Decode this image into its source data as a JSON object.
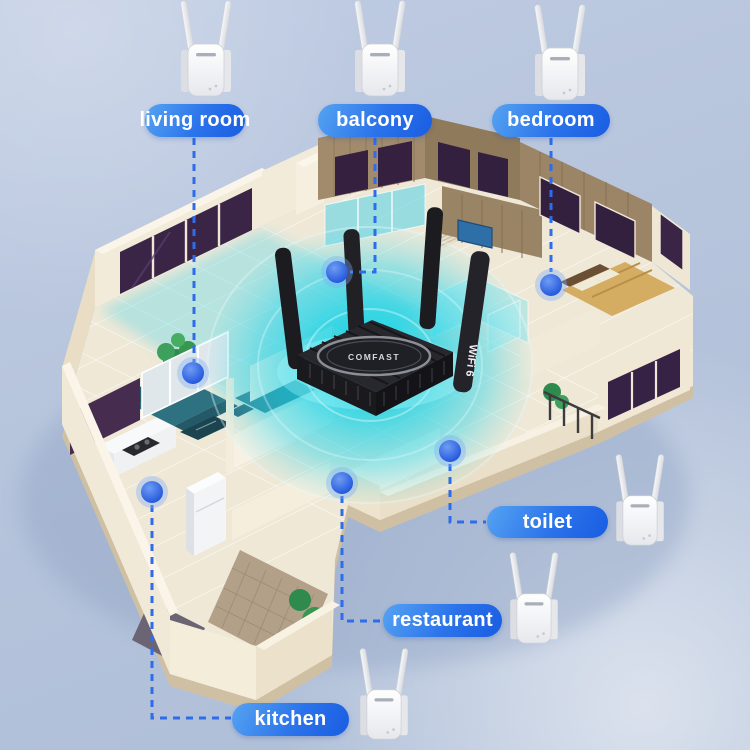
{
  "scene": {
    "description": "isometric house floor plan with wifi mesh coverage",
    "background_color": "#b6c4dc",
    "coverage_color": "#0fd3e8",
    "accent_blue": "#2d6cea",
    "label_gradient_start": "#55a3f2",
    "label_gradient_end": "#195de2"
  },
  "router": {
    "brand": "COMFAST",
    "badge": "WiFi 6",
    "antenna_count": 4
  },
  "extenders": {
    "count": 6,
    "color": "white",
    "antenna_count": 2
  },
  "rooms": [
    {
      "id": "living-room",
      "label": "living room"
    },
    {
      "id": "balcony",
      "label": "balcony"
    },
    {
      "id": "bedroom",
      "label": "bedroom"
    },
    {
      "id": "toilet",
      "label": "toilet"
    },
    {
      "id": "restaurant",
      "label": "restaurant"
    },
    {
      "id": "kitchen",
      "label": "kitchen"
    }
  ]
}
